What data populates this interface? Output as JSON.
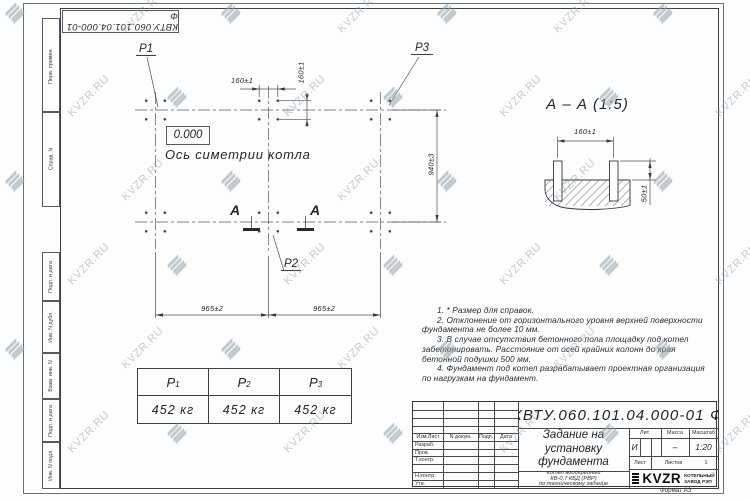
{
  "doc_number": "КВТУ.060.101.04.000-01 Ф",
  "margin_fields": [
    "Перв. примен.",
    "Справ. N",
    "Подп. и дата",
    "Инв. N дубл.",
    "Взам. инв. N",
    "Подп. и дата",
    "Инв. N подл."
  ],
  "plan": {
    "label_p1": "P1",
    "label_p2": "P2",
    "label_p3": "P3",
    "elevation": "0.000",
    "axis_label": "Ось симетрии котла",
    "dim_bolt_h": "160±1",
    "dim_bolt_v": "160±1",
    "dim_width": "940±3",
    "dim_span_left": "965±2",
    "dim_span_right": "965±2",
    "cut_letter_left": "А",
    "cut_letter_right": "А"
  },
  "section": {
    "title": "А – А (1:5)",
    "dim_bolts": "160±1",
    "dim_height": "50±1"
  },
  "notes": [
    "1. * Размер для справок.",
    "2. Отклонение от горизонтального уровня верхней поверхности фундамента не более 10 мм.",
    "3. В случае отсутствия бетонного пола площадку под котел забетонировать. Расстояние от осей крайних колонн до края бетонной подушки 500 мм.",
    "4. Фундамент под котел разрабатывает проектная организация по нагрузкам на фундамент."
  ],
  "load_table": {
    "cols": [
      {
        "name": "P",
        "sub": "1",
        "value": "452 кг"
      },
      {
        "name": "P",
        "sub": "2",
        "value": "452 кг"
      },
      {
        "name": "P",
        "sub": "3",
        "value": "452 кг"
      }
    ]
  },
  "title_block": {
    "title_lines": [
      "Задание на",
      "установку",
      "фундамента"
    ],
    "subtitle_lines": [
      "Котел водогрейный",
      "КВ-0,7 КБД (РВР)",
      "по техническому задание"
    ],
    "header_cols": [
      "Изм.Лист",
      "N докум.",
      "Подп.",
      "Дата"
    ],
    "row_labels": [
      "Разраб.",
      "Пров.",
      "Т.контр.",
      "",
      "Н.контр.",
      "Утв."
    ],
    "lit_label": "Лит.",
    "lit_value": "И",
    "mass_label": "Масса",
    "mass_value": "–",
    "scale_label": "Масштаб",
    "scale_value": "1:20",
    "sheet_label": "Лист",
    "sheets_label": "Листов",
    "sheets_value": "1",
    "logo_text": "KVZR",
    "logo_sub1": "КОТЕЛЬНЫЙ",
    "logo_sub2": "ЗАВОД РЭП",
    "format_label": "Формат А3"
  },
  "watermark": {
    "text": "KVZR.RU"
  }
}
